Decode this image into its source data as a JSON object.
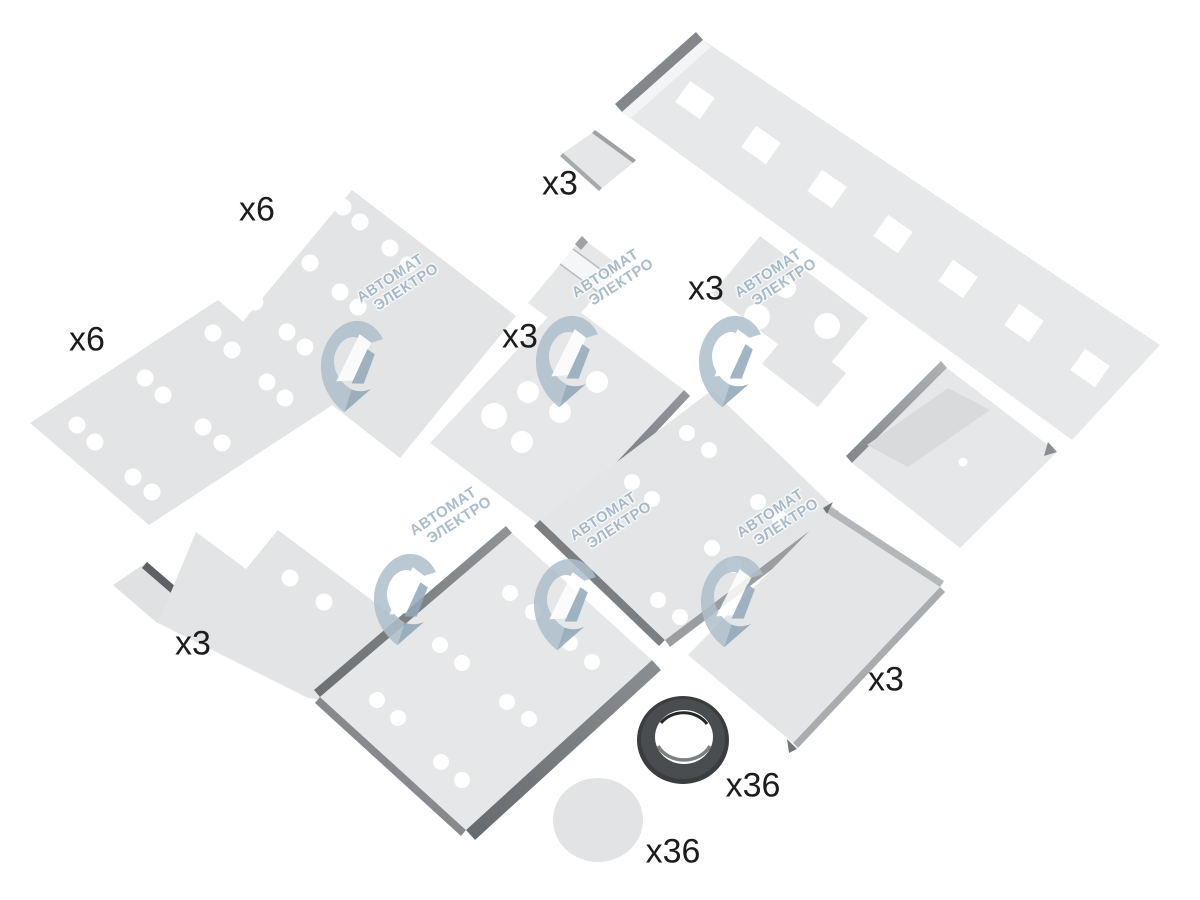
{
  "watermark": {
    "line1": "АВТОМАТ",
    "line2": "ЭЛЕКТРО"
  },
  "quantity_labels": [
    {
      "part": "plate-top-x6",
      "text": "x6"
    },
    {
      "part": "plate-left-x6",
      "text": "x6"
    },
    {
      "part": "small-channel",
      "text": "x3"
    },
    {
      "part": "t-plate",
      "text": "x3"
    },
    {
      "part": "center-bracket",
      "text": "x3"
    },
    {
      "part": "l-plate",
      "text": "x3"
    },
    {
      "part": "bottom-right-tray",
      "text": "x3"
    },
    {
      "part": "grommet-ring",
      "text": "x36"
    },
    {
      "part": "round-disc",
      "text": "x36"
    }
  ],
  "colors": {
    "background": "#ffffff",
    "plate_fill": "#e4e5e7",
    "plate_fill_light": "#e8e9eb",
    "thick_edge_dark": "#6f7275",
    "thick_edge_mid": "#9a9da0",
    "grommet_dark": "#3a3c3f",
    "label_text": "#1c1c1c",
    "watermark_blue": "#9db2c3"
  }
}
